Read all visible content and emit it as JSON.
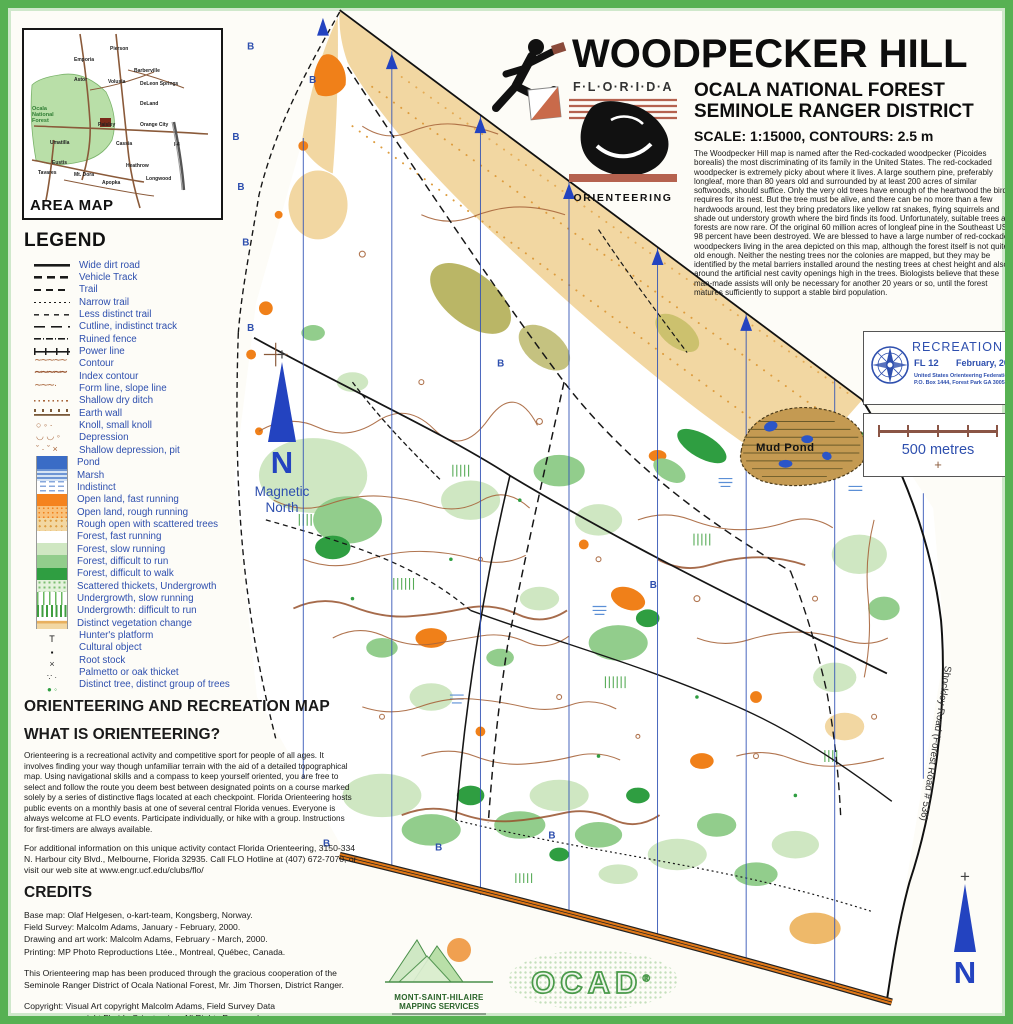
{
  "frame": {
    "border_color": "#57b153"
  },
  "area_map": {
    "label": "AREA MAP",
    "towns": [
      {
        "name": "Pierson",
        "x": 86,
        "y": 16
      },
      {
        "name": "Emporia",
        "x": 50,
        "y": 27
      },
      {
        "name": "Barberville",
        "x": 110,
        "y": 38
      },
      {
        "name": "DeLeon Springs",
        "x": 116,
        "y": 51
      },
      {
        "name": "Astor",
        "x": 50,
        "y": 47
      },
      {
        "name": "Volusia",
        "x": 84,
        "y": 49
      },
      {
        "name": "DeLand",
        "x": 116,
        "y": 71
      },
      {
        "name": "Ocala National Forest",
        "x": 8,
        "y": 76,
        "cls": "forest"
      },
      {
        "name": "Paisley",
        "x": 74,
        "y": 92
      },
      {
        "name": "Orange City",
        "x": 116,
        "y": 92
      },
      {
        "name": "I-4",
        "x": 150,
        "y": 112
      },
      {
        "name": "Umatilla",
        "x": 26,
        "y": 110
      },
      {
        "name": "Cassia",
        "x": 92,
        "y": 111
      },
      {
        "name": "Eustis",
        "x": 28,
        "y": 130
      },
      {
        "name": "Heathrow",
        "x": 102,
        "y": 133
      },
      {
        "name": "Tavares",
        "x": 14,
        "y": 140
      },
      {
        "name": "Mt. Dora",
        "x": 50,
        "y": 142
      },
      {
        "name": "Apopka",
        "x": 78,
        "y": 150
      },
      {
        "name": "Longwood",
        "x": 122,
        "y": 146
      }
    ]
  },
  "legend": {
    "title": "LEGEND",
    "items": [
      {
        "label": "Wide dirt road",
        "cls": "s-road"
      },
      {
        "label": "Vehicle Track",
        "cls": "s-vtrack"
      },
      {
        "label": "Trail",
        "cls": "s-trail"
      },
      {
        "label": "Narrow trail",
        "cls": "s-narrow"
      },
      {
        "label": "Less distinct trail",
        "cls": "s-less"
      },
      {
        "label": "Cutline, indistinct track",
        "cls": "s-cutline"
      },
      {
        "label": "Ruined fence",
        "cls": "s-fence"
      },
      {
        "label": "Power line",
        "cls": "s-power"
      },
      {
        "label": "Contour",
        "cls": "s-contour"
      },
      {
        "label": "Index contour",
        "cls": "s-index"
      },
      {
        "label": "Form line, slope line",
        "cls": "s-form"
      },
      {
        "label": "Shallow dry ditch",
        "cls": "s-ditch"
      },
      {
        "label": "Earth wall",
        "cls": "s-earthwall"
      },
      {
        "label": "Knoll, small knoll",
        "cls": "s-knoll"
      },
      {
        "label": "Depression",
        "cls": "s-depression"
      },
      {
        "label": "Shallow depression, pit",
        "cls": "s-shallowdep"
      },
      {
        "label": "Pond",
        "cls": "w-pond",
        "sw": true
      },
      {
        "label": "Marsh",
        "cls": "w-marsh",
        "sw": true
      },
      {
        "label": "Indistinct",
        "cls": "w-indistinct",
        "sw": true
      },
      {
        "label": "Open land, fast running",
        "cls": "w-openfast",
        "sw": true
      },
      {
        "label": "Open land, rough running",
        "cls": "w-openrough",
        "sw": true
      },
      {
        "label": "Rough open with scattered trees",
        "cls": "w-roughopen",
        "sw": true
      },
      {
        "label": "Forest, fast running",
        "cls": "w-forestfast",
        "sw": true
      },
      {
        "label": "Forest, slow running",
        "cls": "w-forestslow",
        "sw": true
      },
      {
        "label": "Forest, difficult to run",
        "cls": "w-forestdiffrun",
        "sw": true
      },
      {
        "label": "Forest, difficult to walk",
        "cls": "w-forestdiffwalk",
        "sw": true
      },
      {
        "label": "Scattered thickets, Undergrowth",
        "cls": "w-thickets",
        "sw": true
      },
      {
        "label": "Undergrowth, slow running",
        "cls": "w-underslow",
        "sw": true
      },
      {
        "label": "Undergrowth: difficult to run",
        "cls": "w-underdiff",
        "sw": true
      },
      {
        "label": "Distinct vegetation change",
        "cls": "w-vegchange",
        "sw": true
      },
      {
        "label": "Hunter's platform",
        "cls": "p-hunter",
        "pt": true
      },
      {
        "label": "Cultural object",
        "cls": "p-cultural",
        "pt": true
      },
      {
        "label": "Root stock",
        "cls": "p-root",
        "pt": true
      },
      {
        "label": "Palmetto or oak thicket",
        "cls": "p-palmetto",
        "pt": true
      },
      {
        "label": "Distinct tree, distinct group of trees",
        "cls": "p-tree",
        "pt": true
      }
    ]
  },
  "sections": {
    "combo_title": "ORIENTEERING AND RECREATION MAP",
    "what_is_title": "WHAT IS ORIENTEERING?",
    "what_is_body": "Orienteering is a recreational activity and competitive sport for people of all ages. It involves finding your way though unfamiliar terrain with the aid of a detailed topographical map.  Using navigational skills and a compass to keep yourself oriented, you are free to select and follow the route you deem best between designated points on a course marked solely by a series of distinctive flags located at each checkpoint.  Florida Orienteering hosts public events on a monthly basis at one of several central Florida venues.  Everyone is always welcome at FLO events.  Participate individually, or hike with a group. Instructions for first-timers are always available.",
    "contact_body": "For additional information on this unique activity contact Florida Orienteering, 3150-334 N. Harbour city Blvd., Melbourne, Florida 32935.  Call FLO Hotline at (407) 672-7070, or visit our web site at www.engr.ucf.edu/clubs/flo/",
    "credits_title": "CREDITS",
    "credits_lines": [
      "Base map: Olaf Helgesen, o-kart-team, Kongsberg, Norway.",
      "Field Survey: Malcolm Adams, January - February, 2000.",
      "Drawing and art work: Malcolm Adams, February - March, 2000.",
      "Printing: MP Photo Reproductions Ltée., Montreal, Québec, Canada."
    ],
    "cooperation_body": "This Orienteering map has been produced through the gracious cooperation of the Seminole Ranger District of Ocala National Forest, Mr. Jim Thorsen, District Ranger.",
    "copyright_line1": "Copyright: Visual Art copyright Malcolm Adams, Field Survey Data",
    "copyright_line2": "copyright Florida Orienteering.  All Rights Reserved."
  },
  "header": {
    "title": "WOODPECKER HILL",
    "subtitle1": "OCALA NATIONAL FOREST",
    "subtitle2": "SEMINOLE RANGER DISTRICT",
    "scale_line": "SCALE:  1:15000,  CONTOURS: 2.5 m",
    "description": "The Woodpecker Hill map is named after the Red-cockaded woodpecker (Picoides borealis) the most discriminating of its family in the United States. The red-cockaded woodpecker is extremely picky about where it lives. A large southern pine, preferably longleaf, more than 80 years old and surrounded by at least 200 acres of similar softwoods, should suffice.  Only the very old trees have enough of the heartwood the bird requires for its nest. But the tree must be alive, and there can be no more than a few hardwoods around, lest they bring predators like yellow rat snakes, flying squirrels and shade out understory growth where the bird finds its food.  Unfortunately, suitable trees and forests are now rare. Of the original 60 million acres of longleaf pine in the Southeast US, 98 percent have been destroyed. We are blessed to have a large number of red-cockaded woodpeckers living in the area depicted on this map, although the forest itself is not quite old enough.  Neither the nesting trees nor the colonies are mapped, but they may be identified by the metal barriers installed around the nesting trees at chest height and also around the artificial nest cavity openings high in the trees. Biologists believe that these man-made assists will only be necessary for another 20 years or so, until the forest matures sufficiently to support a stable bird population.",
    "florida_logo_top": "F·L·O·R·I·D·A",
    "florida_logo_bottom": "ORIENTEERING"
  },
  "recreation_badge": {
    "title": "RECREATION MAP",
    "code": "FL 12",
    "date": "February, 2000",
    "org_line1": "United States Orienteering Federation",
    "org_line2": "P.O. Box 1444, Forest Park GA  30051"
  },
  "scale_bar": {
    "label": "500 metres",
    "cross": "+"
  },
  "north_arrows": {
    "n": "N",
    "magnetic_line1": "Magnetic",
    "magnetic_line2": "North",
    "cross": "+"
  },
  "map": {
    "mud_pond_label": "Mud Pond",
    "shockley_road_label": "Shockley Road (Forest Road # 536)",
    "boundary_marker": "B",
    "b_markers": [
      [
        243,
        42
      ],
      [
        306,
        76
      ],
      [
        228,
        134
      ],
      [
        233,
        185
      ],
      [
        238,
        241
      ],
      [
        243,
        328
      ],
      [
        497,
        364
      ],
      [
        320,
        852
      ],
      [
        434,
        856
      ],
      [
        549,
        844
      ],
      [
        652,
        589
      ]
    ],
    "colors": {
      "open_orange": "#f08019",
      "rough_open_tan": "#f2d7a2",
      "forest_slow_green": "#cfe7c2",
      "forest_diff_run_green": "#92cd8c",
      "forest_diff_walk_green": "#2f9e41",
      "contour_brown": "#a8663c",
      "water_blue": "#3a6cc6",
      "meridian_blue": "#3253b5",
      "legend_text_blue": "#2e4fae",
      "paved_road_orange": "#e07818",
      "frame_green": "#57b153"
    }
  },
  "footer_logos": {
    "msh_line1": "MONT-SAINT-HILAIRE",
    "msh_line2": "MAPPING SERVICES",
    "ocad": "OCAD",
    "ocad_reg": "®"
  }
}
